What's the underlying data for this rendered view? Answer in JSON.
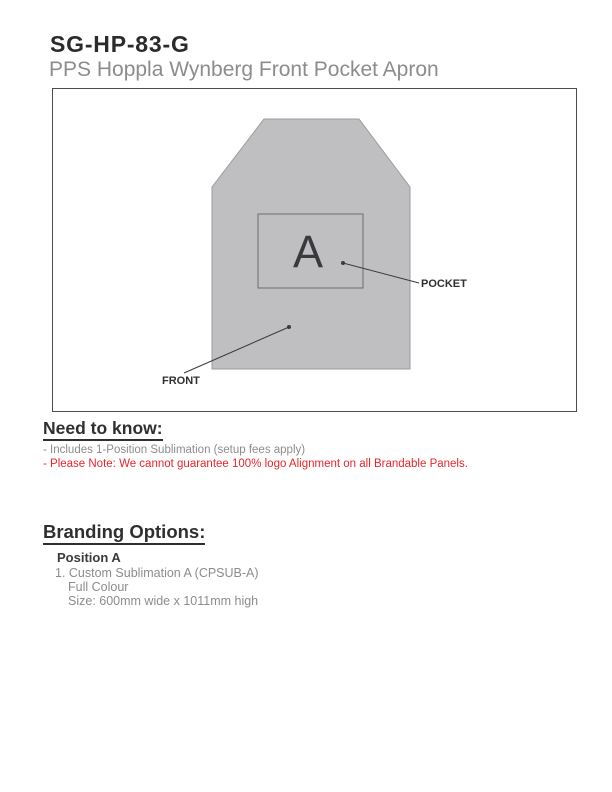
{
  "header": {
    "product_code": "SG-HP-83-G",
    "product_name": "PPS Hoppla Wynberg Front Pocket Apron"
  },
  "diagram": {
    "position_marker": "A",
    "pocket_label": "POCKET",
    "front_label": "FRONT"
  },
  "need_to_know": {
    "heading": "Need to know:",
    "items": [
      "- Includes 1-Position Sublimation (setup fees apply)",
      "- Please Note: We cannot guarantee 100% logo Alignment on all Brandable Panels."
    ]
  },
  "branding_options": {
    "heading": "Branding Options:",
    "positions": [
      {
        "name": "Position A",
        "lines": [
          "1. Custom Sublimation A (CPSUB-A)",
          "Full Colour",
          "Size: 600mm wide x 1011mm high"
        ]
      }
    ]
  },
  "colors": {
    "apron_fill": "#bfbfc1",
    "apron_border": "#9b9b9d",
    "pocket_border": "#6e6e70",
    "heading_dark": "#2f2f2f",
    "body_gray": "#8c8c8c",
    "warning_red": "#e8252c"
  }
}
